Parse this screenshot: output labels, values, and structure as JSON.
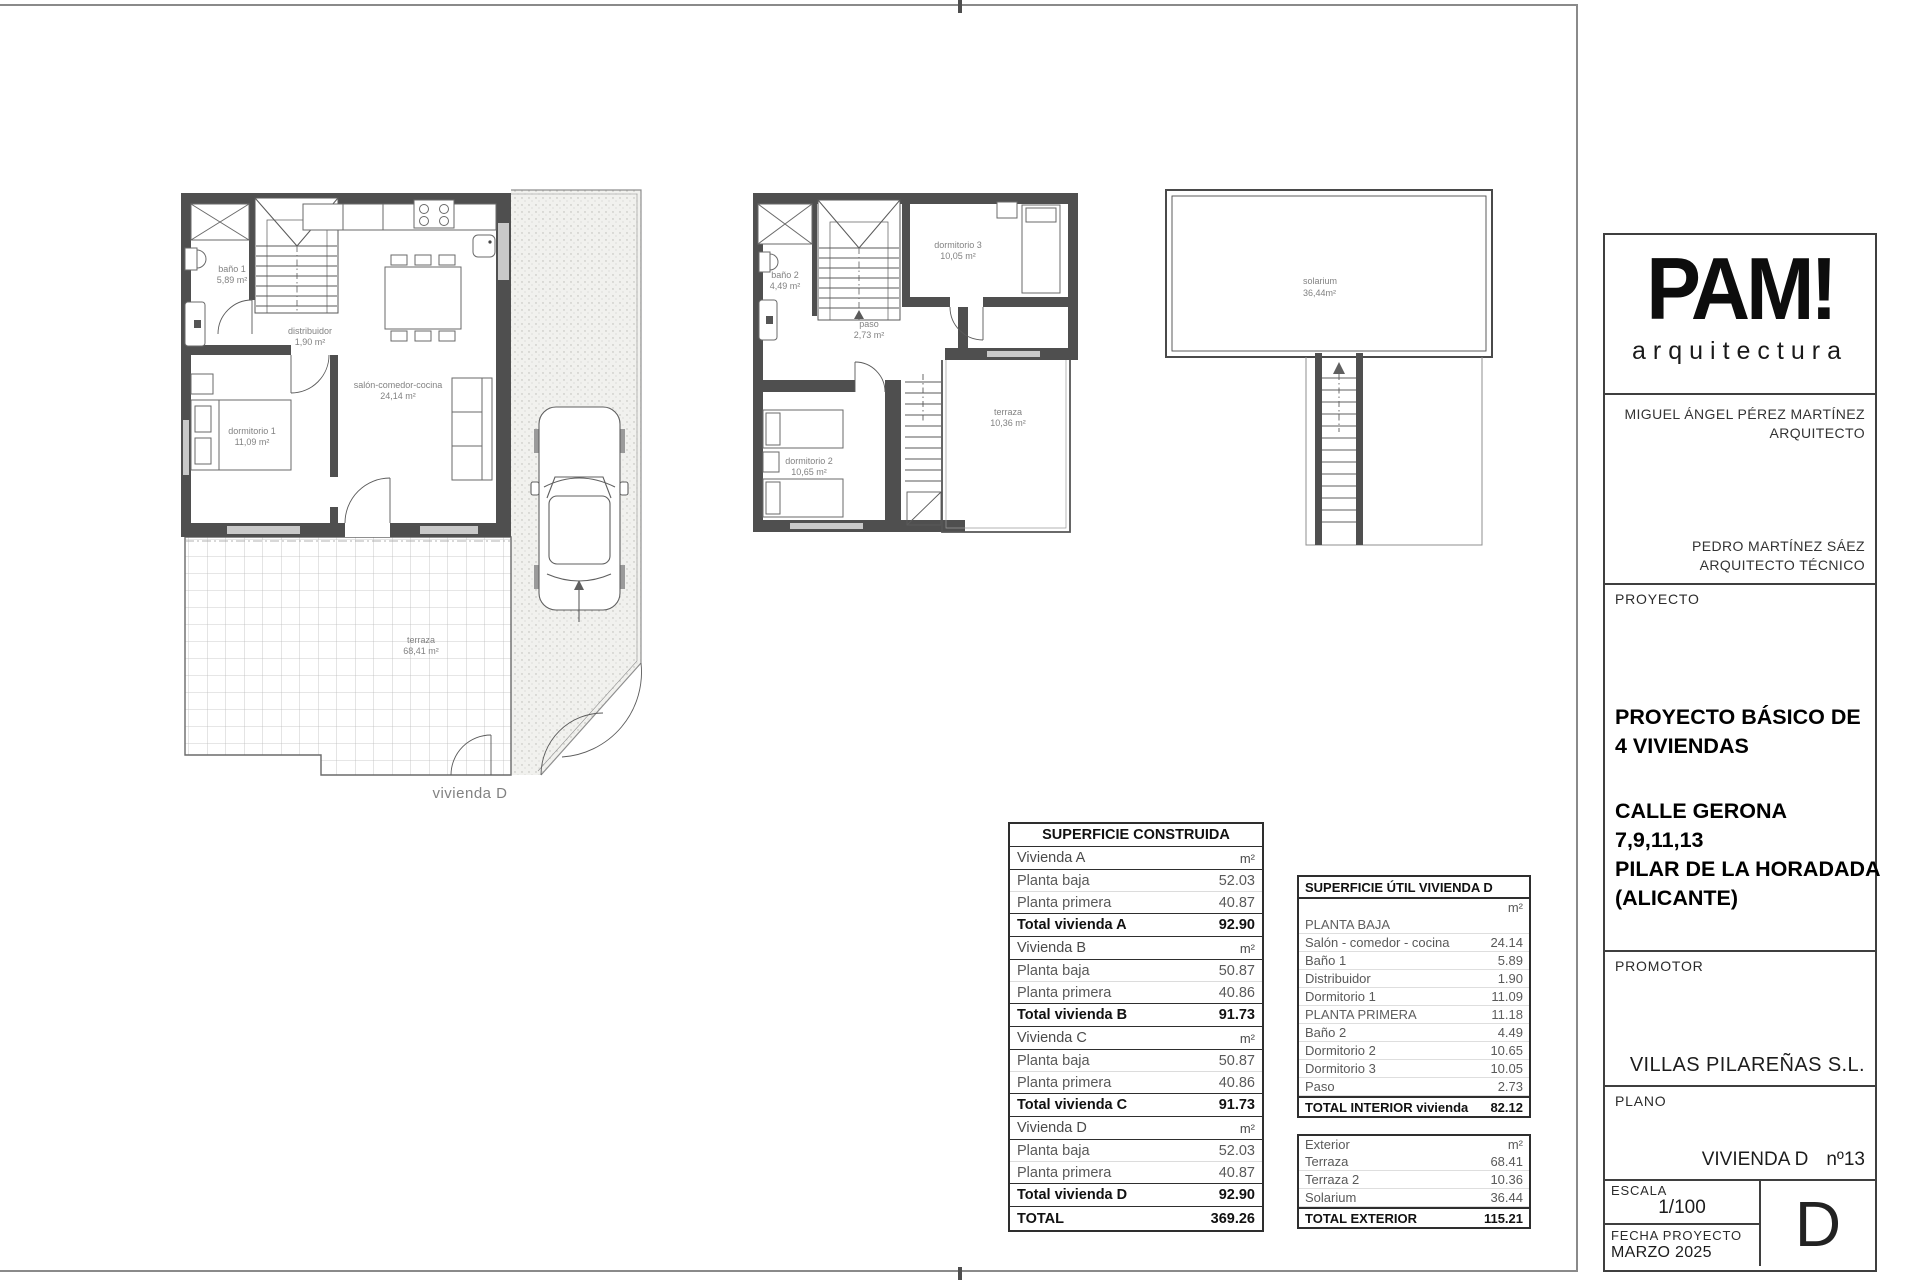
{
  "plans": {
    "ground_floor": {
      "bano1": {
        "name": "baño 1",
        "area": "5,89 m²"
      },
      "distribuidor": {
        "name": "distribuidor",
        "area": "1,90 m²"
      },
      "dormitorio1": {
        "name": "dormitorio 1",
        "area": "11,09 m²"
      },
      "salon": {
        "name": "salón-comedor-cocina",
        "area": "24,14 m²"
      },
      "terraza": {
        "name": "terraza",
        "area": "68,41 m²"
      },
      "caption": "vivienda D"
    },
    "first_floor": {
      "bano2": {
        "name": "baño 2",
        "area": "4,49 m²"
      },
      "paso": {
        "name": "paso",
        "area": "2,73 m²"
      },
      "dormitorio3": {
        "name": "dormitorio 3",
        "area": "10,05 m²"
      },
      "dormitorio2": {
        "name": "dormitorio 2",
        "area": "10,65 m²"
      },
      "terraza": {
        "name": "terraza",
        "area": "10,36 m²"
      }
    },
    "roof": {
      "solarium": {
        "name": "solarium",
        "area": "36,44m²"
      }
    }
  },
  "tables": {
    "construida": {
      "title": "SUPERFICIE CONSTRUIDA",
      "unit": "m²",
      "row_labels": {
        "planta_baja": "Planta baja",
        "planta_primera": "Planta primera"
      },
      "groups": [
        {
          "vivienda": "Vivienda A",
          "planta_baja": "52.03",
          "planta_primera": "40.87",
          "total_label": "Total vivienda A",
          "total": "92.90"
        },
        {
          "vivienda": "Vivienda B",
          "planta_baja": "50.87",
          "planta_primera": "40.86",
          "total_label": "Total vivienda B",
          "total": "91.73"
        },
        {
          "vivienda": "Vivienda C",
          "planta_baja": "50.87",
          "planta_primera": "40.86",
          "total_label": "Total vivienda C",
          "total": "91.73"
        },
        {
          "vivienda": "Vivienda D",
          "planta_baja": "52.03",
          "planta_primera": "40.87",
          "total_label": "Total vivienda D",
          "total": "92.90"
        }
      ],
      "total_label": "TOTAL",
      "total": "369.26"
    },
    "util": {
      "title": "SUPERFICIE ÚTIL VIVIENDA D",
      "unit": "m²",
      "interior": [
        {
          "label": "PLANTA BAJA",
          "value": ""
        },
        {
          "label": "Salón - comedor - cocina",
          "value": "24.14"
        },
        {
          "label": "Baño 1",
          "value": "5.89"
        },
        {
          "label": "Distribuidor",
          "value": "1.90"
        },
        {
          "label": "Dormitorio 1",
          "value": "11.09"
        },
        {
          "label": "PLANTA PRIMERA",
          "value": "11.18"
        },
        {
          "label": "Baño 2",
          "value": "4.49"
        },
        {
          "label": "Dormitorio 2",
          "value": "10.65"
        },
        {
          "label": "Dormitorio 3",
          "value": "10.05"
        },
        {
          "label": "Paso",
          "value": "2.73"
        }
      ],
      "interior_total_label": "TOTAL INTERIOR vivienda",
      "interior_total": "82.12",
      "exterior_header": "Exterior",
      "exterior": [
        {
          "label": "Terraza",
          "value": "68.41"
        },
        {
          "label": "Terraza 2",
          "value": "10.36"
        },
        {
          "label": "Solarium",
          "value": "36.44"
        }
      ],
      "exterior_total_label": "TOTAL EXTERIOR",
      "exterior_total": "115.21"
    }
  },
  "titleblock": {
    "logo": {
      "brand": "PAM!",
      "subtitle": "arquitectura"
    },
    "architect1": {
      "name": "MIGUEL ÁNGEL PÉREZ MARTÍNEZ",
      "role": "ARQUITECTO"
    },
    "architect2": {
      "name": "PEDRO MARTÍNEZ SÁEZ",
      "role": "ARQUITECTO TÉCNICO"
    },
    "proyecto": {
      "label": "PROYECTO",
      "title_line1": "PROYECTO BÁSICO DE",
      "title_line2": "4 VIVIENDAS",
      "address_line1": "CALLE GERONA",
      "address_line2": "7,9,11,13",
      "address_line3": "PILAR DE LA HORADADA",
      "address_line4": "(ALICANTE)"
    },
    "promotor": {
      "label": "PROMOTOR",
      "value": "VILLAS PILAREÑAS S.L."
    },
    "plano": {
      "label": "PLANO",
      "value": "VIVIENDA D",
      "number": "nº13"
    },
    "escala": {
      "label": "ESCALA",
      "value": "1/100"
    },
    "fecha": {
      "label": "FECHA PROYECTO",
      "value": "MARZO 2025"
    },
    "sheet_letter": "D"
  }
}
